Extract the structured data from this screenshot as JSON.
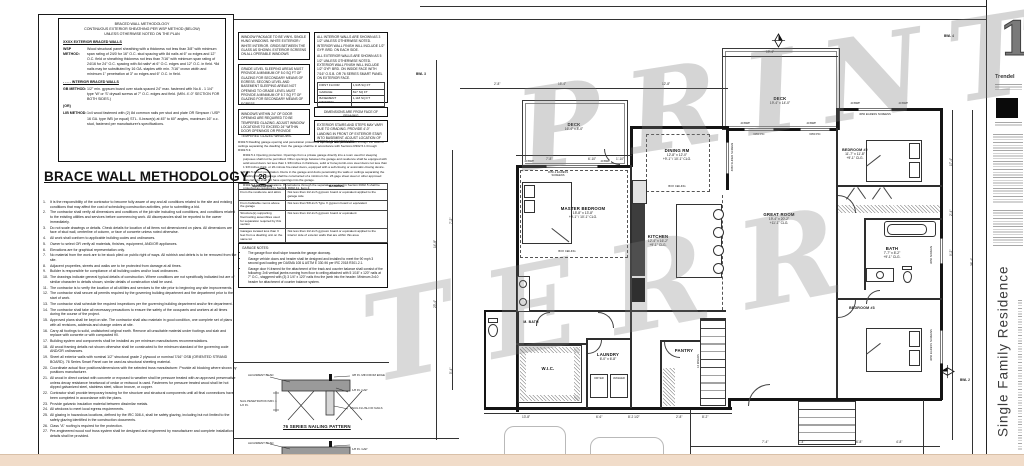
{
  "left_panel": {
    "methodology": {
      "title_lines": [
        "BRACED WALL METHODOLOGY",
        "CONTINUOUS EXTERIOR SHEATHING PER WSP METHOD (BELOW)",
        "UNLESS OTHERWISE NOTED ON THE PLAN"
      ],
      "exterior_heading": "XXXX  EXTERIOR BRACED WALLS",
      "wsp_label": "WSP METHOD:",
      "wsp_text": "Wood structural panel sheathing with a thickness not less than 3/8\" with minimum span rating of 24/0 for 16\" O.C. stud spacing with 8d nails at 6\" oc edges and 12\" O.C. field or sheathing thickness not less than 7/16\" with minimum span rating of 24/16 for 24\" O.C. spacing with 8d nails* at 6\" O.C. edges and 12\" O.C. in field.  *8d nails may be substituted by 16 GA. staples with min. 7/16\" crown width and minimum 1\" penetration at 3\" oc edges and 6\" O.C. in field.",
      "interior_heading": "- - - -  INTERIOR BRACED WALLS",
      "gb_label": "GB METHOD:",
      "gb_text": "1/2\" min. gypsum board over studs spaced 24\" max. fastened with No.6 - 1 1/4\" type 'W' or 'S' drywall screws at 7\" O.C. edges and field. (MIN. 4'-0\" SECTION FOR BOTH SIDES.)",
      "or_label": "(OR)",
      "lib_label": "LIB METHOD:",
      "lib_text": "1x4 wood fastened with (2) 8d common nails per stud and plate OR Simpson / USP 16 GA. type WB (or equal) STL. X-brace(s) at 45° to 60° angles, maximum 16\" o.c. stud, fastened per manufacturer's specifications."
    },
    "title": "BRACE WALL METHODOLOGY",
    "title_badge": "20",
    "general_notes": [
      "It is the responsibility of the contractor to become fully aware of any and all conditions related to the site and existing conditions that may affect the cost of scheduling construction activities, prior to submitting a bid.",
      "The contractor shall verify all dimensions and conditions of the job site including soil conditions, and conditions related to the existing utilities and services before commencing work. All discrepancies shall be reported to the owner immediately.",
      "Do not scale drawings or details. Check details for location of all items not dimensioned on plans. All dimensions are face of stud wall, centerline of column, or face of concrete unless noted otherwise.",
      "All work shall conform to applicable building codes and ordinances.",
      "Owner to select OR verify all materials, finishes, equipment, AND/OR appliances.",
      "Elevations are for graphical representation only.",
      "No material from the work are to be stock piled on public right of ways. All rubbish and debris is to be removed from the site.",
      "Adjacent properties, streets and walks are to be protected from damage at all times.",
      "Builder is responsible for compliance of all building codes and/or local ordinances.",
      "The drawings indicate general typical details of construction. Where conditions are not specifically indicated but are of similar character to details shown, similar details of construction shall be used.",
      "The contractor is to verify the location of all utilities and services to the site prior to beginning any site improvements.",
      "The contractor shall secure all permits required by the governing building department and fire department prior to the start of work.",
      "The contractor shall schedule the required inspections per the governing building department and/or fire department.",
      "The contractor shall take all necessary precautions to ensure the safety of the occupants and workers at all times during the course of the project.",
      "Approved plans shall be kept on site. The contractor shall also maintain in good condition, one complete set of plans with all revisions, addenda and change orders at site.",
      "Carry all footings to solid, undisturbed original earth. Remove all unsuitable material under footings and slab and replace with concrete or with compacted fill.",
      "Building system and components shall be installed as per minimum manufactures recommendations.",
      "All wood framing details not shown otherwise shall be constructed to the minimum standard of the governing code AND/OR ordinances.",
      "Sheet all exterior walls with nominal 1/2\" structural grade 2 plywood or nominal 7/16\" OSB (ORIENTED STRAND BOARD). 76 Series Smart Panel can be used as structural sheeting material.",
      "Coordinate actual floor positions/dimensions with the selected truss manufacturer. Provide all blocking where shown by positions manufacturer.",
      "All wood in direct contact with concrete or exposed to weather shall be pressure treated with an approved preservative unless decay resistance heartwood of cedar or redwood is used. Fasteners for pressure treated wood shall be hot dipped galvanized steel, stainless steel, silicon bronze, or copper.",
      "Contractor shall provide temporary bracing for the structure and structural components until all final connections have been completed in accordance with the plans.",
      "Provide galvanic insulation material between dissimilar metals.",
      "All windows to meet local egress requirements.",
      "All glazing in hazardous locations, defined by the IRC 308.4, shall be safety glazing, including but not limited to the safety glazing identified in the construction documents.",
      "Class \"A\" roofing is required for fire protection.",
      "Pre-engineered wood roof truss system shall be designed and engineered by manufacturer and complete installation details shall be provided."
    ]
  },
  "notes_column": {
    "window_package": "WINDOW PACKAGE TO BE VINYL SINGLE HUNG WINDOWS.  WHITE EXTERIOR / WHITE INTERIOR.  GRIDS BETWEEN THE GLASS AS SHOWN.  EXTERIOR SCREENS ON ALL OPERABLE WINDOWS",
    "egress_glazing": "GRADE LEVEL SLEEPING AREAS MUST PROVIDE A MINIMUM OF 5.0 SQ FT OF GLAZING FOR SECONDARY MEANS OF EGRESS. SECOND LEVEL AND BASEMENT SLEEPING AREAS NOT OPENING TO GRADE LEVEL MUST PROVIDE A MINIMUM OF 5.7 SQ FT OF GLAZING FOR SECONDARY MEANS OF EGRESS.",
    "tempered_glazing": "WINDOWS WITHIN 24\" OF DOOR OPENING ARE REQUIRED TO BE TEMPERED GLAZING. ADJUST WINDOW LOCATIONS TO EXCEED 24\" WITHIN DOOR OPENINGS OR PROVIDE TEMPERED GLAZED WINDOWS.",
    "interior_walls": "ALL INTERIOR WALLS ARE SHOWN AS 3 1/2\" UNLESS OTHERWISE NOTED. INTERIOR WALL FINISH WILL INCLUDE 1/2\" GYP. BRD. ON EACH SIDE.",
    "exterior_walls": "ALL EXTERIOR WALLS ARE SHOWN AS 5 1/2\" UNLESS OTHERWISE NOTED. EXTERIOR WALL FINISH WILL INCLUDE 1/2\" GYP. BRD. ON INSIDE FACE WITH 7/16\" O.S.B. or 76 SERIES SMART PANEL ON EXTERIOR FACE.",
    "area_table": {
      "rows": [
        {
          "label": "FIRST FLOOR",
          "value": "1,945 SQ FT"
        },
        {
          "label": "GARAGE",
          "value": "817 SQ FT"
        },
        {
          "label": "BASEMENT FINISHED",
          "value": "1,118 SQ FT"
        },
        {
          "label": "BASEMENT TOTAL",
          "value": "1,905 SQ FT"
        }
      ]
    },
    "dimensions_note": "DIMENSIONS ARE FROM FACE OF FRAMING",
    "exterior_stairs_note": "EXTERIOR STAIRS AND STEPS MAY VARY DUE TO GRADING. PROVIDE 4'-0\" LANDING IN FRONT OF EXTERIOR STAIR INTO BASEMENT. ADJUST LOCATION OF STEPS AS NECESSARY.",
    "r302": {
      "intro": "R302.5 Dwelling garage opening and penetration protection. Openings and penetrations through the walls or ceilings separating the dwelling from the garage shall be in accordance with Sections R302.5.1 through R302.5.3.",
      "p1": "R302.5.1 Opening protection. Openings from a private garage directly into a room used for sleeping purposes shall not be permitted. Other openings between the garage and residence shall be equipped with solid wood doors not less than 1 3/8 inches in thickness, solid or honeycomb-core steel doors not less than 1 3/8 inches thick, or 20-minute fire-rated doors, equipped with a self-closing or automatic-closing device.",
      "p2": "R302.5.2 Duct penetration. Ducts in the garage and ducts penetrating the walls or ceilings separating the dwelling from the garage shall be constructed of a minimum No. 26 gage sheet steel or other approved material and shall not have openings into the garage.",
      "p3": "R302.5.3 Other penetrations. Penetrations through the separation required in Section R302.5 shall be protected as required by Section R302.11, Item 4."
    },
    "separation_table": {
      "headers": [
        "SEPARATION",
        "MATERIAL"
      ],
      "rows": [
        [
          "From the residence and attics",
          "Not less than 1/2-inch gypsum board or equivalent applied to the garage side"
        ],
        [
          "From habitable rooms above the garage",
          "Not less than 5/8-inch Type X gypsum board or equivalent"
        ],
        [
          "Structure(s) supporting floor/ceiling assemblies used for separation required by this section",
          "Not less than 1/2-inch gypsum board or equivalent"
        ],
        [
          "Garages located less than 3 feet from a dwelling unit on the same lot",
          "Not less than 1/2-inch gypsum board or equivalent applied to the interior side of exterior walls that are within this area"
        ]
      ]
    },
    "garage_notes_title": "GARAGE NOTES:",
    "garage_notes": [
      "The garage floor shall slope towards the garage doorway.",
      "Garage vehicle doors and header shall be designed and installed to meet the 90 mph 3 second gust loading per DASMA 108 & ASTM E 330-96 per IRC 2018 R301.2.1.",
      "Garage door H-framed for the attachment of the track and counter balance shall consist of the following: 2x6 vertical jambs running from floor to ceiling attached with 5 1/16\" x 120\" nails at 7\" O.C., staggered with (3) 3 1/4\" x 120\" nails thru the jamb into the header. Minimum 2x10 header for attachment of counter balance system."
    ],
    "nailing_detail": {
      "alignment_bead": "ALIGNMENT BEAD",
      "min_from_edge": "3/8 IN. MIN FROM EDGE",
      "gap": "1/8 IN. GAP",
      "nail_penetration": "NAIL PENETRATION MIN. 1 1/2 IN.",
      "snug_flush": "SNUG FLUSH OF NAILS",
      "title": "76 SERIES NAILING PATTERN"
    }
  },
  "plan": {
    "rooms": [
      {
        "name": "DECK",
        "dims": "16'-4\" x 8'-0\"",
        "clg": ""
      },
      {
        "name": "MASTER BEDROOM",
        "dims": "15'-8\" x 13'-8\"",
        "clg": "+9'-1\" / 10'-1\" CLG."
      },
      {
        "name": "DINING RM",
        "dims": "12'-8\" x 12'-0\"",
        "clg": "+9'-1\" / 10'-1\" CLG."
      },
      {
        "name": "KITCHEN",
        "dims": "12'-4\" x 16'-2\"",
        "clg": "+9'-1\" CLG."
      },
      {
        "name": "DECK",
        "dims": "19'-4\" x 14'-0\"",
        "clg": ""
      },
      {
        "name": "GREAT ROOM",
        "dims": "19'-4\" x 20'-2\"",
        "clg": "+11'-1\" CLG."
      },
      {
        "name": "BEDROOM #2",
        "dims": "11'-7\" x 11'-8\"",
        "clg": "+9'-1\" CLG."
      },
      {
        "name": "BATH",
        "dims": "7'-7\" x 8'-2\"",
        "clg": "+9'-1\" CLG."
      },
      {
        "name": "W.I.C.",
        "dims": "",
        "clg": ""
      },
      {
        "name": "LAUNDRY",
        "dims": "6'-0\" x 6'-8\"",
        "clg": "+9'-1\" CLG."
      },
      {
        "name": "PANTRY",
        "dims": "",
        "clg": ""
      },
      {
        "name": "BEDROOM #3",
        "dims": "",
        "clg": ""
      },
      {
        "name": "M. BATH",
        "dims": "",
        "clg": ""
      }
    ],
    "windows": [
      "3050-2 EGRESS SCREENS",
      "6050 PIC",
      "6050 PIC",
      "4050 SLIDER SCREEN",
      "3050 EGRESS SCREENS",
      "3050 SCREEN",
      "3050 EGRESS SCREENS"
    ],
    "appliances": {
      "dryer": "DRYER",
      "washer": "WASHER"
    },
    "box_ceiling": "BOX CEILING",
    "stair_label": "14 RISERS",
    "bwp_tag": "40 BWP",
    "bwl": [
      "BWL 3",
      "BWL 4",
      "BWL 2"
    ],
    "dims": [
      "2'-8\"",
      "15'-4\"",
      "12'-8\"",
      "19'-4\"",
      "17'-4\"",
      "7'-8\"",
      "7'-2\"",
      "14'-8\"",
      "23'-4\"",
      "5'-4\"",
      "13'-8\"",
      "6'-6\"",
      "8'-2 1/2\"",
      "2'-8\"",
      "8'-2\"",
      "9'-2\"",
      "36'-4\"",
      "1'-4\"",
      "6'-8\"",
      "4'-8\"",
      "7'-4\"",
      "2'-4\"",
      "6'-10\"",
      "1'-10\""
    ]
  },
  "watermark": {
    "fragments": [
      "PRINT",
      "TERR"
    ]
  },
  "title_block": {
    "brand": "Trendel",
    "logo_numeral": "1",
    "vertical_title": "Single Family Residence"
  },
  "colors": {
    "paper": "#ffffff",
    "ink": "#141414",
    "peach": "#f1dcc9",
    "watermark_gray": "#7d7d7d"
  }
}
